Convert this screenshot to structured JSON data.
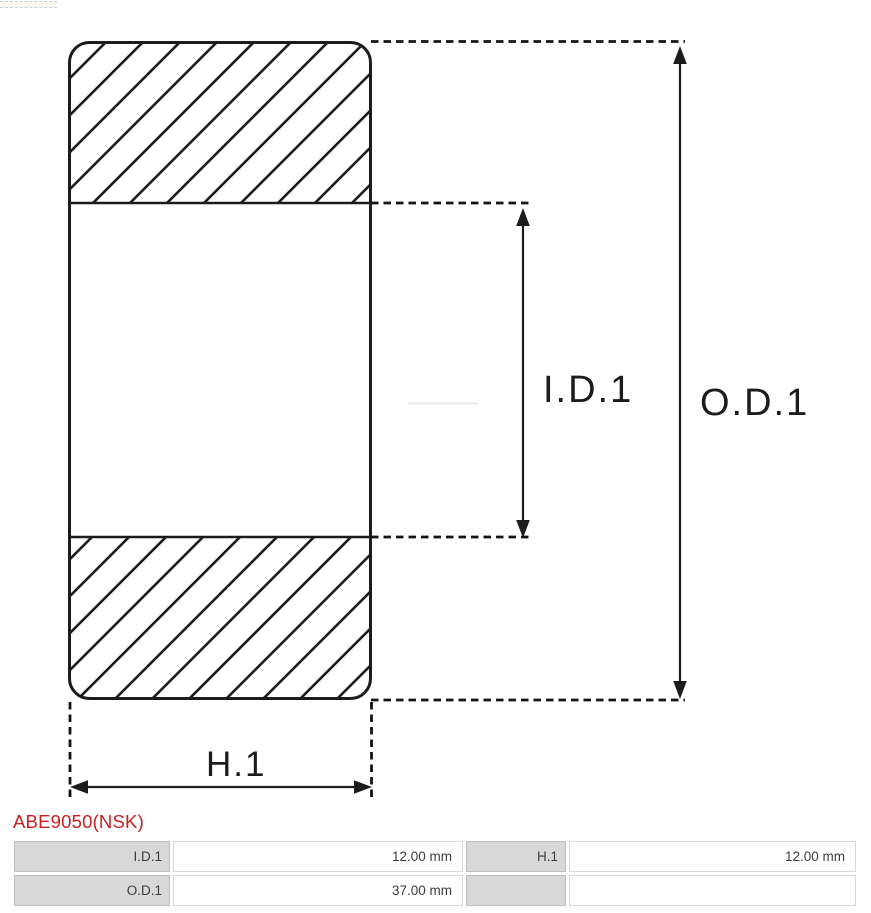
{
  "diagram": {
    "id_label": "I.D.1",
    "od_label": "O.D.1",
    "h_label": "H.1",
    "line_color": "#1c1c1c"
  },
  "part": {
    "number": "ABE9050(NSK)",
    "accent_color": "#cb1f1f"
  },
  "spec_table": {
    "label_bg": "#d8d8d8",
    "rows": [
      {
        "cells": [
          {
            "label": "I.D.1",
            "value": "12.00 mm"
          },
          {
            "label": "H.1",
            "value": "12.00 mm"
          }
        ]
      },
      {
        "cells": [
          {
            "label": "O.D.1",
            "value": "37.00 mm"
          },
          {
            "label": "",
            "value": ""
          }
        ]
      }
    ]
  }
}
